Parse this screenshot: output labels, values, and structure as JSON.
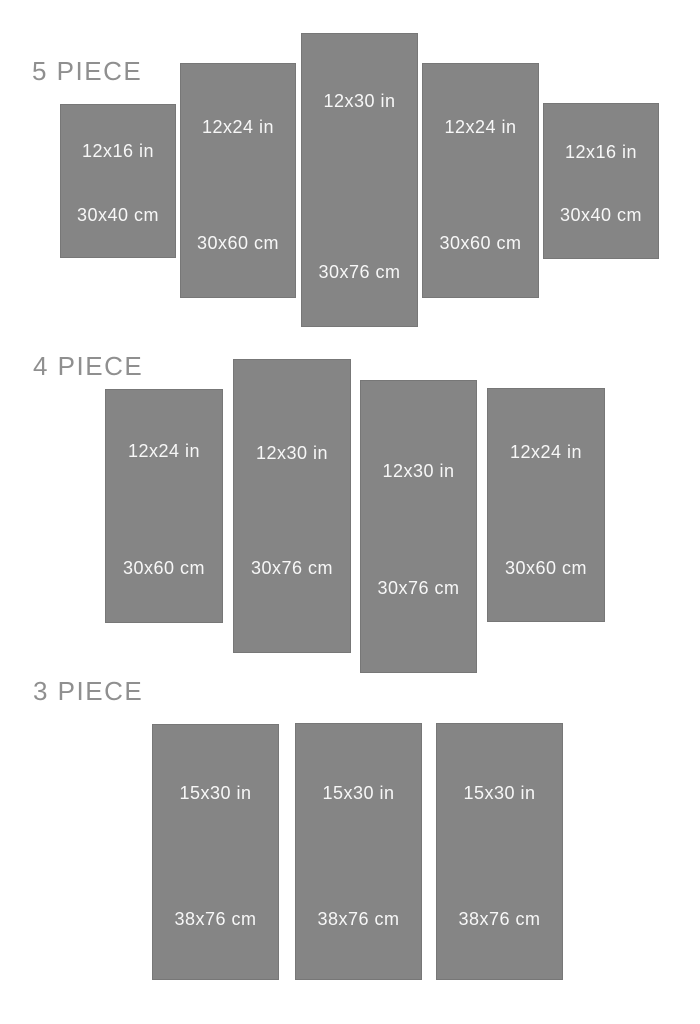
{
  "colors": {
    "background": "#ffffff",
    "panel_fill": "#858585",
    "panel_border": "#777777",
    "panel_text": "#f7f7f7",
    "section_label_text": "#8f8f8f"
  },
  "sections": [
    {
      "label": "5 PIECE",
      "panels": [
        {
          "size_in": "12x16 in",
          "size_cm": "30x40 cm"
        },
        {
          "size_in": "12x24 in",
          "size_cm": "30x60 cm"
        },
        {
          "size_in": "12x30 in",
          "size_cm": "30x76 cm"
        },
        {
          "size_in": "12x24 in",
          "size_cm": "30x60 cm"
        },
        {
          "size_in": "12x16 in",
          "size_cm": "30x40 cm"
        }
      ]
    },
    {
      "label": "4 PIECE",
      "panels": [
        {
          "size_in": "12x24 in",
          "size_cm": "30x60 cm"
        },
        {
          "size_in": "12x30 in",
          "size_cm": "30x76 cm"
        },
        {
          "size_in": "12x30 in",
          "size_cm": "30x76 cm"
        },
        {
          "size_in": "12x24 in",
          "size_cm": "30x60 cm"
        }
      ]
    },
    {
      "label": "3 PIECE",
      "panels": [
        {
          "size_in": "15x30 in",
          "size_cm": "38x76 cm"
        },
        {
          "size_in": "15x30 in",
          "size_cm": "38x76 cm"
        },
        {
          "size_in": "15x30 in",
          "size_cm": "38x76 cm"
        }
      ]
    }
  ]
}
